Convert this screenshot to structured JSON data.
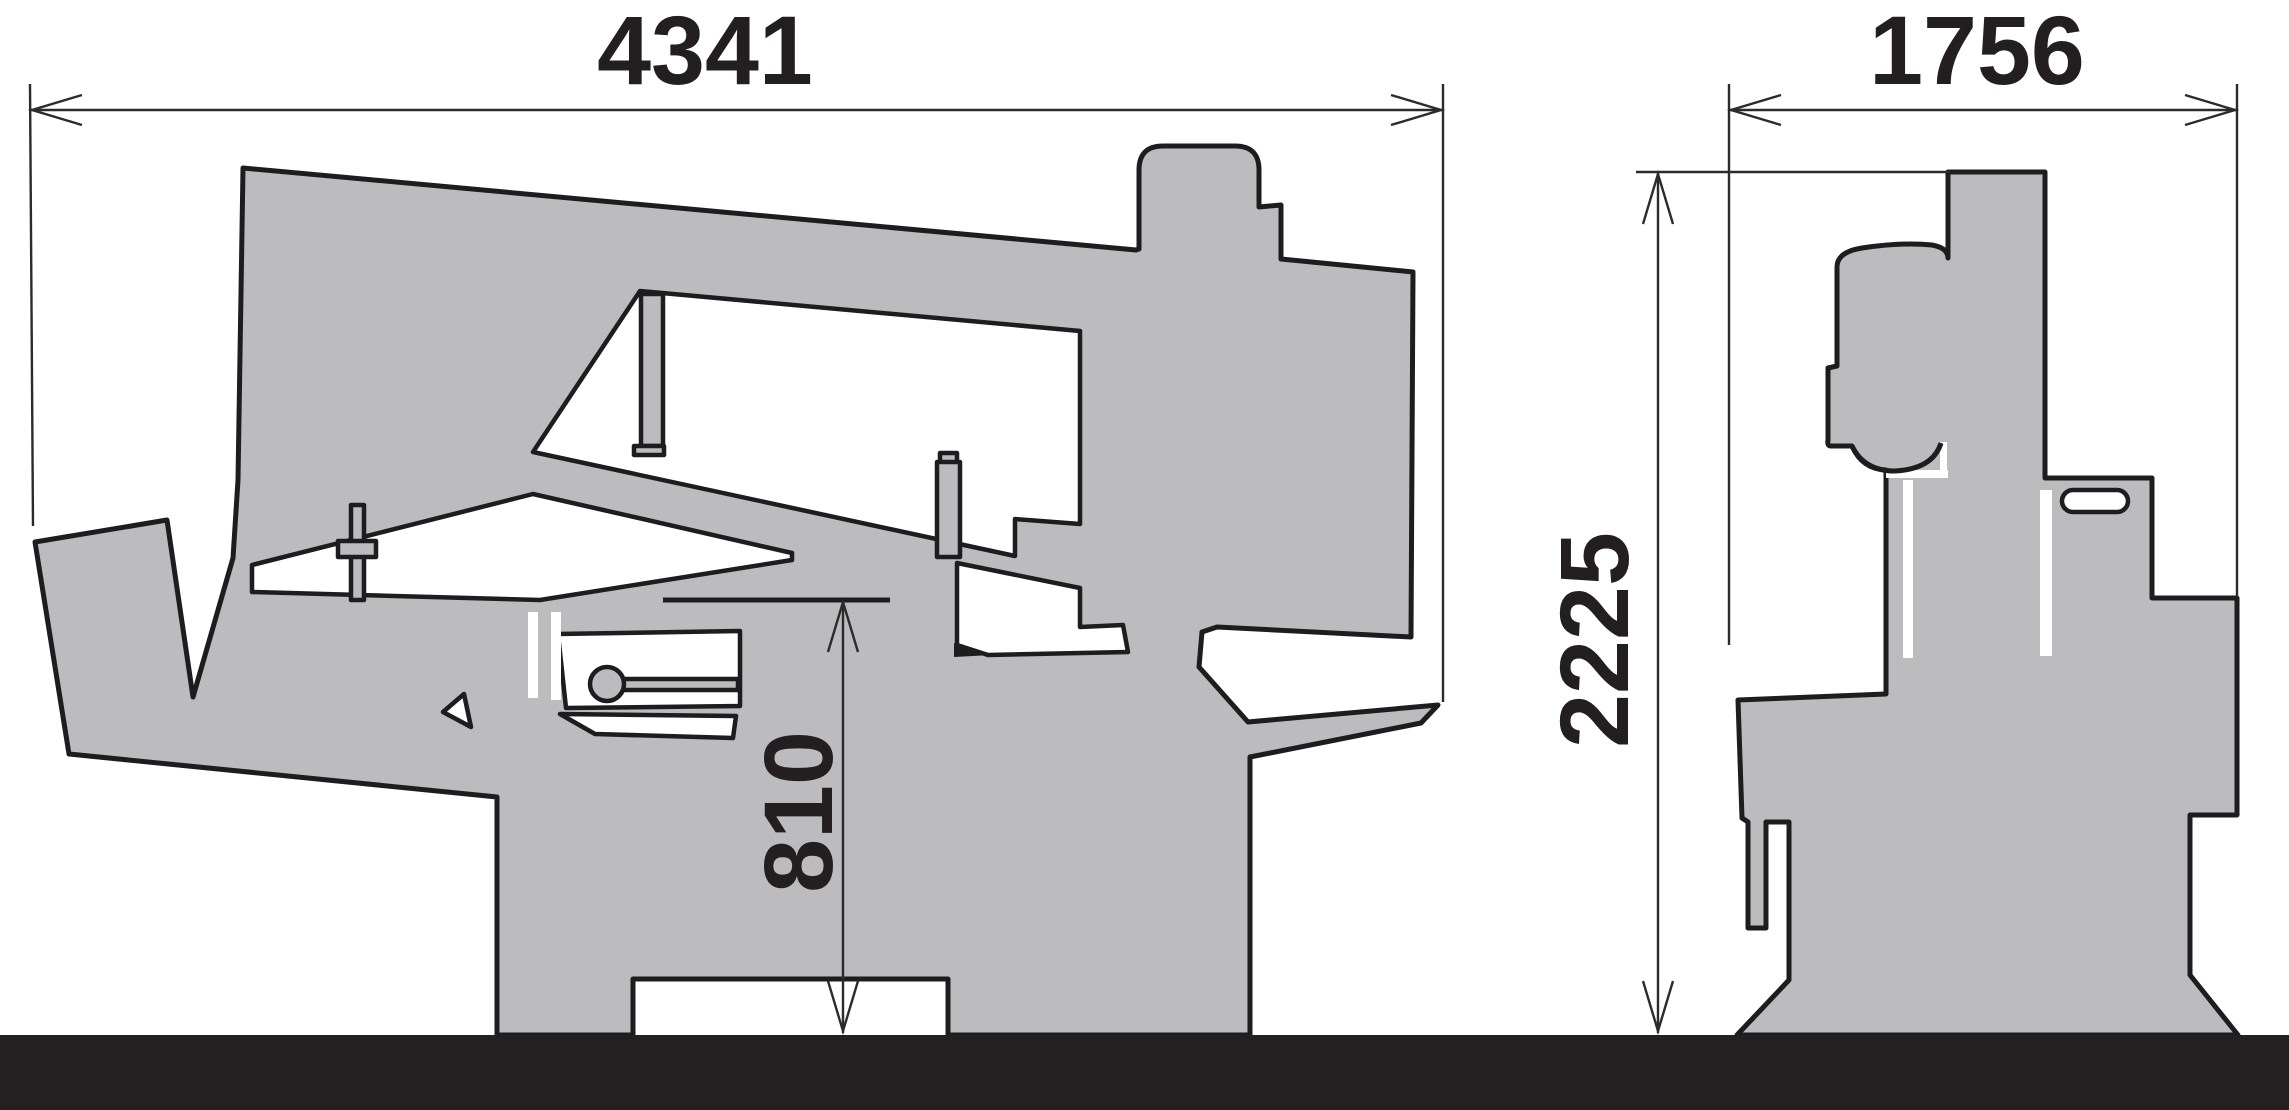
{
  "drawing": {
    "type": "technical-dimension-drawing",
    "subject": "band saw machine silhouette, side view and end view, with overall dimensions",
    "units_shown": "none (bare numbers, millimetres implied)",
    "colors": {
      "background": "#ffffff",
      "machine_fill": "#bcbcbe",
      "outline": "#1d1d1f",
      "floor": "#241f21",
      "dimension_lines": "#2b2b2b",
      "dimension_text": "#231f20"
    },
    "dimensions": {
      "overall_length": "4341",
      "end_view_width": "1756",
      "overall_height": "2225",
      "table_height": "810"
    },
    "annotations": [
      {
        "value": "4341",
        "orientation": "horizontal",
        "applies_to": "side view overall length"
      },
      {
        "value": "1756",
        "orientation": "horizontal",
        "applies_to": "end view overall width"
      },
      {
        "value": "2225",
        "orientation": "vertical-rotated",
        "applies_to": "end view overall height"
      },
      {
        "value": "810",
        "orientation": "vertical-rotated",
        "applies_to": "side view table height above floor"
      }
    ]
  }
}
